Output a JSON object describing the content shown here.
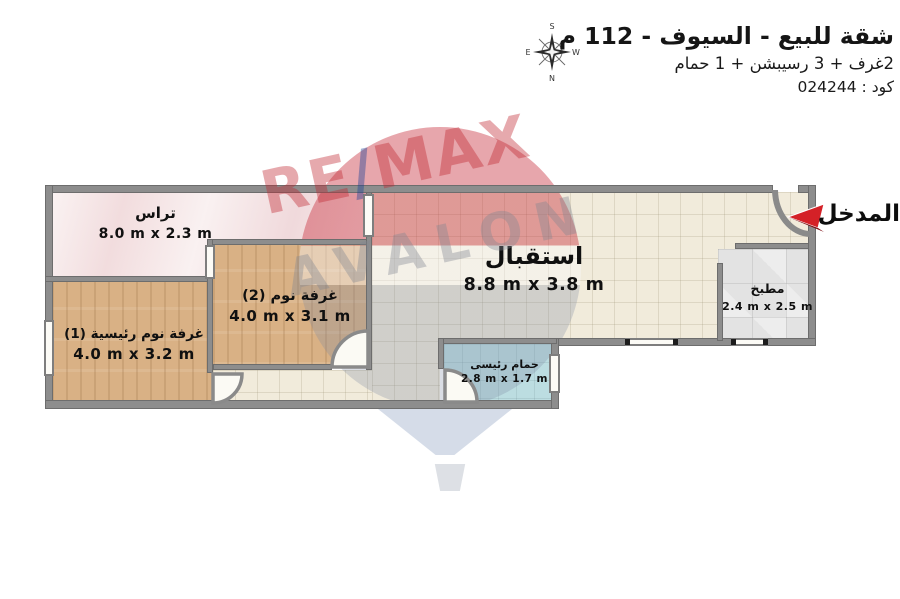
{
  "header": {
    "title": "شقة للبيع - السيوف - 112 م",
    "subtitle": "2غرف + 3 رسيبشن + 1 حمام",
    "code": "كود : 024244"
  },
  "compass": {
    "top": "S",
    "bottom": "N",
    "left": "E",
    "right": "W"
  },
  "entrance": {
    "label": "المدخل",
    "arrow_color": "#d42127"
  },
  "watermark": {
    "remax_left": "RE",
    "remax_slash": "/",
    "remax_right": "MAX",
    "avalon": "AVALON"
  },
  "palette": {
    "wall": "#8d8d8d",
    "terrace_floor": "#f4e3e3",
    "bedroom_floor": "#d9b185",
    "reception_floor": "#f1ebdb",
    "bathroom_floor": "#bcdde1",
    "kitchen_floor": "#e3e3e3",
    "arrow_red": "#d42127"
  },
  "rooms": [
    {
      "id": "terrace",
      "name": "تراس",
      "dims": "8.0 m x 2.3 m"
    },
    {
      "id": "bedroom2",
      "name": "غرفة نوم (2)",
      "dims": "4.0 m x 3.1 m"
    },
    {
      "id": "master",
      "name": "غرفة نوم رئيسية (1)",
      "dims": "4.0 m x 3.2 m"
    },
    {
      "id": "reception",
      "name": "استقبال",
      "dims": "8.8 m x 3.8 m"
    },
    {
      "id": "bathroom",
      "name": "حمام رئيسى",
      "dims": "2.8 m x 1.7 m"
    },
    {
      "id": "kitchen",
      "name": "مطبخ",
      "dims": "2.4 m x 2.5 m"
    }
  ]
}
